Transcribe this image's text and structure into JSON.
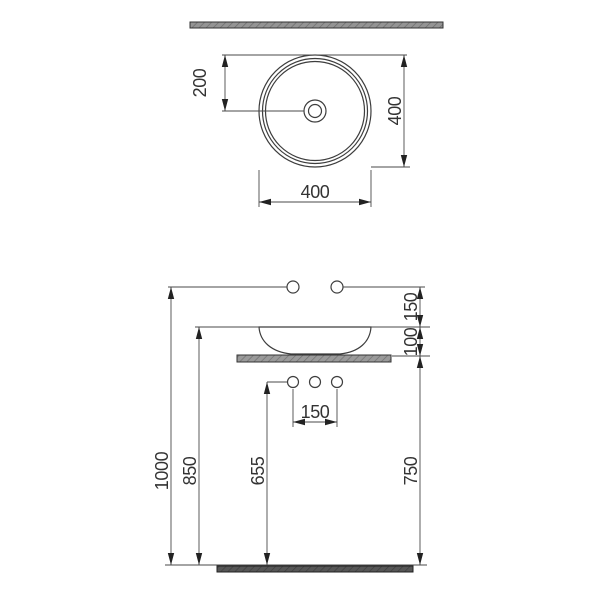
{
  "drawing": {
    "subject": "round countertop washbasin installation drawing",
    "units": "mm",
    "views": [
      "top view",
      "front elevation"
    ]
  },
  "colors": {
    "background": "#ffffff",
    "line": "#3d3d3d",
    "text": "#333333",
    "wall_fill": "#949494",
    "counter_fill": "#9a9a9a",
    "floor_fill": "#565656"
  },
  "top_view": {
    "drain_offset_label": "200",
    "basin_height_label": "400",
    "basin_width_label": "400"
  },
  "front_view": {
    "tap_to_rim_label": "150",
    "rim_to_counter_label": "100",
    "drain_spacing_label": "150",
    "tap_height_label": "1000",
    "rim_height_label": "850",
    "drain_height_label": "655",
    "counter_height_label": "750"
  }
}
